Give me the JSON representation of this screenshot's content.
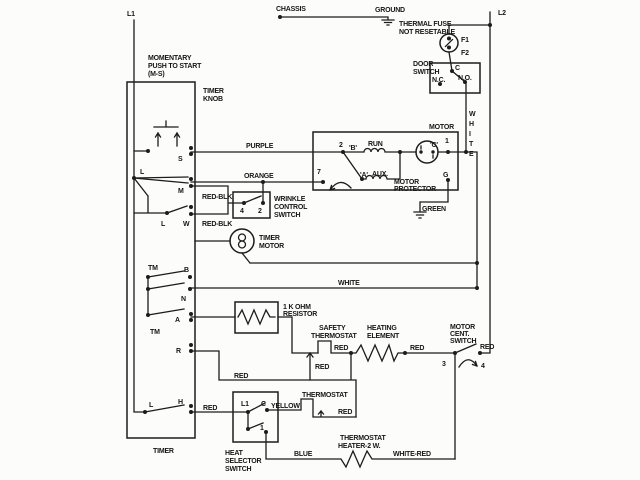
{
  "colors": {
    "ink": "#1c1c1c",
    "paper": "#fcfcfb"
  },
  "power": {
    "l1": "L1",
    "l2": "L2",
    "chassis": "CHASSIS",
    "ground": "GROUND"
  },
  "thermal_fuse": {
    "label": [
      "THERMAL FUSE",
      "NOT RESETABLE"
    ],
    "f1": "F1",
    "f2": "F2"
  },
  "door_switch": {
    "label": [
      "DOOR",
      "SWITCH"
    ],
    "nc": "N.C.",
    "c": "C",
    "no": "N.O."
  },
  "timer": {
    "name": "TIMER",
    "knob": [
      "TIMER",
      "KNOB"
    ],
    "momentary": [
      "MOMENTARY",
      "PUSH TO START",
      "(M-S)"
    ],
    "terminals": {
      "s": "S",
      "l_upper": "L",
      "m": "M",
      "l_mid": "L",
      "w": "W",
      "tm_upper": "TM",
      "b": "B",
      "n": "N",
      "a": "A",
      "tm_lower": "TM",
      "r": "R",
      "l_lower": "L",
      "h": "H"
    }
  },
  "timer_motor": {
    "label": [
      "TIMER",
      "MOTOR"
    ]
  },
  "wrinkle_switch": {
    "label": [
      "WRINKLE",
      "CONTROL",
      "SWITCH"
    ],
    "terminal_4": "4",
    "terminal_2": "2"
  },
  "motor": {
    "name": "MOTOR",
    "terminal_2": "2",
    "b": "'B'",
    "run": "RUN",
    "terminal_7": "7",
    "a": "'A'",
    "aux": "AUX.",
    "protector": [
      "MOTOR",
      "PROTECTOR"
    ],
    "c": "'C'",
    "terminal_1": "1",
    "ground_terminal": "G"
  },
  "resistor": {
    "label": [
      "1 K OHM",
      "RESISTOR"
    ]
  },
  "safety_thermostat": {
    "label": [
      "SAFETY",
      "THERMOSTAT"
    ]
  },
  "heating_element": {
    "label": [
      "HEATING",
      "ELEMENT"
    ]
  },
  "motor_cent_switch": {
    "label": [
      "MOTOR",
      "CENT.",
      "SWITCH"
    ],
    "terminal_3": "3",
    "terminal_4": "4"
  },
  "thermostat": {
    "label": "THERMOSTAT"
  },
  "thermostat_heater": {
    "label": [
      "THERMOSTAT",
      "HEATER-2 W."
    ]
  },
  "heat_selector": {
    "label": [
      "HEAT",
      "SELECTOR",
      "SWITCH"
    ],
    "l1": "L1",
    "c": "C",
    "terminal_1": "1"
  },
  "wire_colors": {
    "purple": "PURPLE",
    "orange": "ORANGE",
    "red_blk_1": "RED-BLK",
    "red_blk_2": "RED-BLK",
    "white_h": "WHITE",
    "white_v": [
      "W",
      "H",
      "I",
      "T",
      "E"
    ],
    "green": "GREEN",
    "yellow": "YELLOW",
    "blue": "BLUE",
    "white_red": "WHITE-RED",
    "red_r": "RED",
    "red_h": "RED",
    "red_safety_upper": "RED",
    "red_safety_lower": "RED",
    "red_heating": "RED",
    "red_cent": "RED",
    "red_thermostat": "RED"
  }
}
